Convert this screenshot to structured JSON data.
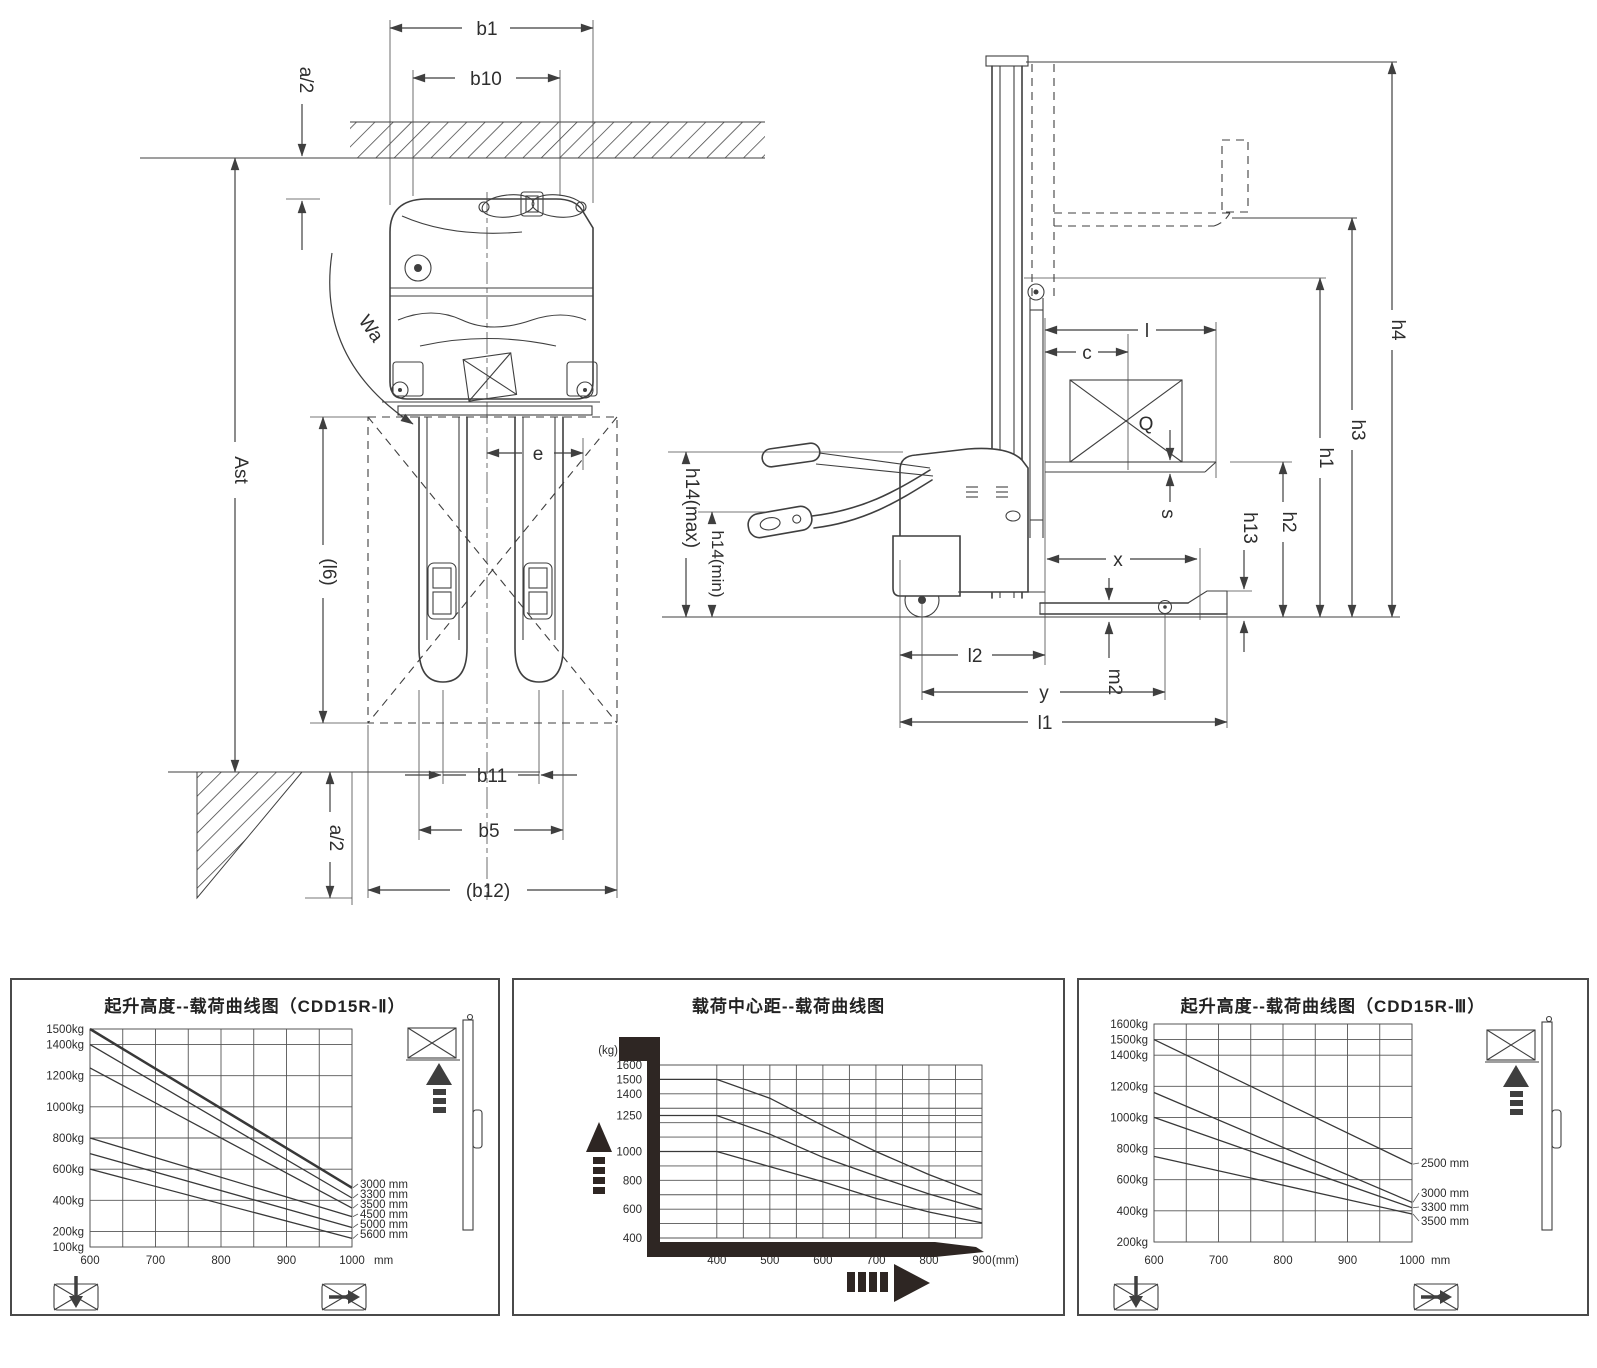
{
  "colors": {
    "ink": "#3f3f3f",
    "background": "#ffffff"
  },
  "diagram": {
    "front_view": {
      "b1": "b1",
      "b10": "b10",
      "a2_top": "a/2",
      "wa": "Wa",
      "ast": "Ast",
      "l6": "(l6)",
      "e": "e",
      "b11": "b11",
      "b5": "b5",
      "b12": "(b12)",
      "a2_bottom": "a/2"
    },
    "side_view": {
      "h4": "h4",
      "h3": "h3",
      "h1": "h1",
      "h2": "h2",
      "h13": "h13",
      "h14_max": "h14(max)",
      "h14_min": "h14(min)",
      "l": "l",
      "c": "c",
      "q": "Q",
      "s": "s",
      "x": "x",
      "l2": "l2",
      "m2": "m2",
      "y": "y",
      "l1": "l1"
    }
  },
  "chart_data": [
    {
      "type": "line",
      "title": "起升高度--载荷曲线图（CDD15R-Ⅱ）",
      "xlabel": "载荷中心距",
      "ylabel": "",
      "x_unit_label": "mm",
      "y_tick_suffix": "kg",
      "xlim": [
        600,
        1000
      ],
      "ylim": [
        100,
        1500
      ],
      "grid": true,
      "legend_position": "right-of-lines",
      "x_ticks": [
        600,
        700,
        800,
        900,
        1000
      ],
      "y_ticks": [
        1500,
        1400,
        1200,
        1000,
        800,
        600,
        400,
        200,
        100
      ],
      "series": [
        {
          "name": "3000 mm",
          "bold": true,
          "points": [
            [
              600,
              1500
            ],
            [
              1000,
              480
            ]
          ]
        },
        {
          "name": "3300 mm",
          "points": [
            [
              600,
              1400
            ],
            [
              1000,
              415
            ]
          ]
        },
        {
          "name": "3500 mm",
          "points": [
            [
              600,
              1250
            ],
            [
              1000,
              350
            ]
          ]
        },
        {
          "name": "4500 mm",
          "points": [
            [
              600,
              800
            ],
            [
              1000,
              295
            ]
          ]
        },
        {
          "name": "5000 mm",
          "points": [
            [
              600,
              700
            ],
            [
              1000,
              225
            ]
          ]
        },
        {
          "name": "5600 mm",
          "points": [
            [
              600,
              600
            ],
            [
              1000,
              155
            ]
          ]
        }
      ]
    },
    {
      "type": "line",
      "title": "载荷中心距--载荷曲线图",
      "ylabel": "(kg)",
      "x_unit_label": "(mm)",
      "y_tick_suffix": "",
      "xlim": [
        291,
        900
      ],
      "ylim": [
        400,
        1600
      ],
      "grid": true,
      "x_ticks": [
        400,
        500,
        600,
        700,
        800,
        900
      ],
      "y_ticks": [
        1600,
        1500,
        1400,
        1250,
        1000,
        800,
        600,
        400
      ],
      "series": [
        {
          "name": "1500",
          "points": [
            [
              291,
              1500
            ],
            [
              400,
              1500
            ],
            [
              500,
              1370
            ],
            [
              600,
              1180
            ],
            [
              700,
              1000
            ],
            [
              800,
              840
            ],
            [
              900,
              700
            ]
          ]
        },
        {
          "name": "1250",
          "points": [
            [
              291,
              1250
            ],
            [
              400,
              1250
            ],
            [
              500,
              1120
            ],
            [
              600,
              960
            ],
            [
              700,
              830
            ],
            [
              800,
              705
            ],
            [
              900,
              600
            ]
          ]
        },
        {
          "name": "1000",
          "points": [
            [
              291,
              1000
            ],
            [
              400,
              1000
            ],
            [
              500,
              895
            ],
            [
              600,
              790
            ],
            [
              700,
              675
            ],
            [
              800,
              580
            ],
            [
              900,
              505
            ]
          ]
        }
      ]
    },
    {
      "type": "line",
      "title": "起升高度--载荷曲线图（CDD15R-Ⅲ）",
      "xlabel": "载荷中心距",
      "ylabel": "",
      "x_unit_label": "mm",
      "y_tick_suffix": "kg",
      "xlim": [
        600,
        1000
      ],
      "ylim": [
        200,
        1600
      ],
      "grid": true,
      "x_ticks": [
        600,
        700,
        800,
        900,
        1000
      ],
      "y_ticks": [
        1600,
        1500,
        1400,
        1200,
        1000,
        800,
        600,
        400,
        200
      ],
      "series": [
        {
          "name": "2500 mm",
          "points": [
            [
              600,
              1500
            ],
            [
              1000,
              700
            ]
          ]
        },
        {
          "name": "3000 mm",
          "points": [
            [
              600,
              1160
            ],
            [
              1000,
              455
            ]
          ]
        },
        {
          "name": "3300 mm",
          "points": [
            [
              600,
              1000
            ],
            [
              1000,
              420
            ]
          ]
        },
        {
          "name": "3500 mm",
          "points": [
            [
              600,
              750
            ],
            [
              1000,
              380
            ]
          ]
        }
      ]
    }
  ]
}
